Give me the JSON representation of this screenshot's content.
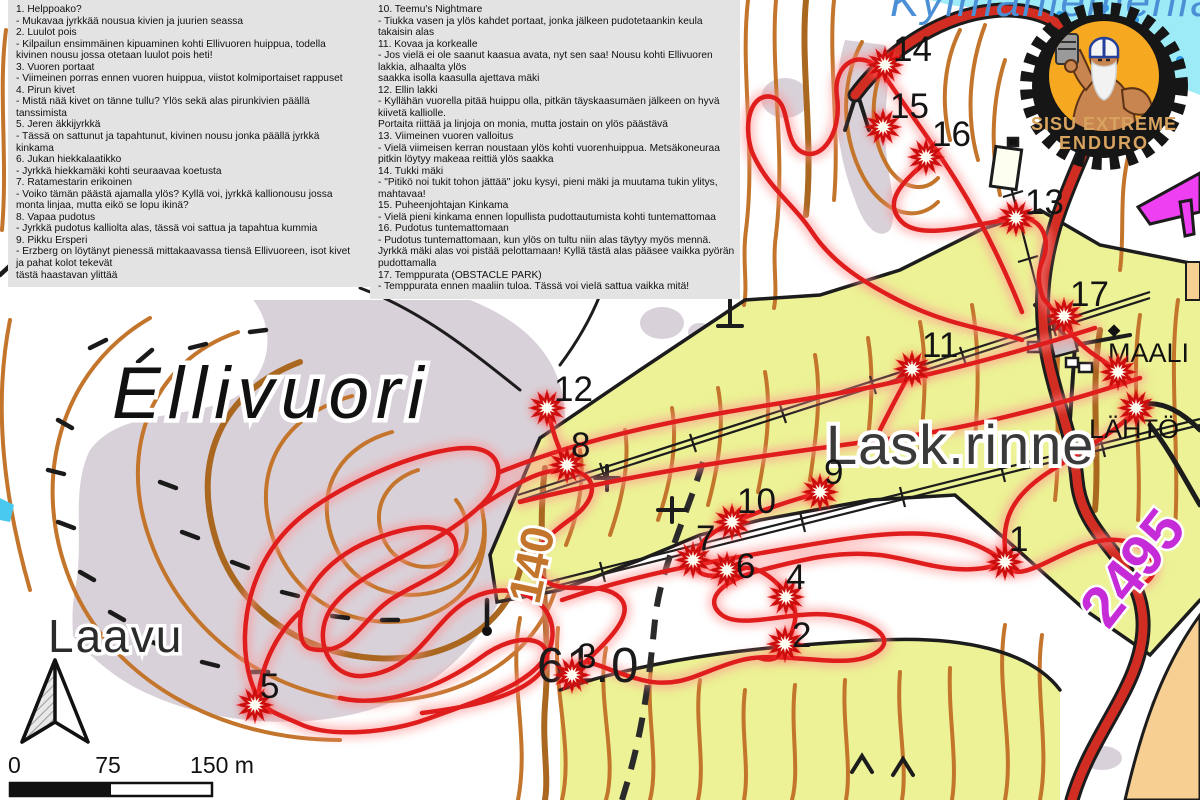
{
  "panels": {
    "left": {
      "lines": [
        "1. Helppoako?",
        "- Mukavaa jyrkkää nousua kivien ja juurien seassa",
        "2. Luulot pois",
        "- Kilpailun ensimmäinen kipuaminen kohti Ellivuoren huippua, todella",
        "kivinen nousu jossa otetaan luulot pois heti!",
        "3. Vuoren portaat",
        "- Viimeinen porras ennen vuoren huippua, viistot kolmiportaiset rappuset",
        "4. Pirun kivet",
        "- Mistä nää kivet on tänne tullu? Ylös sekä alas pirunkivien päällä",
        "tanssimista",
        "5. Jeren äkkijyrkkä",
        "- Tässä on sattunut ja tapahtunut, kivinen nousu jonka päällä jyrkkä",
        "kinkama",
        "6. Jukan hiekkalaatikko",
        "- Jyrkkä hiekkamäki kohti seuraavaa koetusta",
        "7. Ratamestarin erikoinen",
        "- Voiko tämän päästä ajamalla ylös? Kyllä voi, jyrkkä kallionousu jossa",
        "monta linjaa, mutta eikö se lopu ikinä?",
        "8. Vapaa pudotus",
        "- Jyrkkä pudotus kalliolta alas, tässä voi sattua ja tapahtua kummia",
        "9. Pikku Ersperi",
        "- Erzberg on löytänyt pienessä mittakaavassa tiensä Ellivuoreen, isot kivet",
        "ja pahat kolot tekevät",
        "tästä haastavan ylittää"
      ]
    },
    "right": {
      "lines": [
        "10. Teemu's Nightmare",
        "- Tiukka vasen ja ylös kahdet portaat, jonka jälkeen pudotetaankin keula",
        "takaisin alas",
        "11. Kovaa ja korkealle",
        "- Jos vielä ei ole saanut kaasua avata, nyt sen saa! Nousu kohti Ellivuoren",
        "lakkia, alhaalta ylös",
        "saakka isolla kaasulla ajettava mäki",
        "12. Ellin lakki",
        "- Kyllähän vuorella pitää huippu olla, pitkän täyskaasumäen jälkeen on hyvä",
        "kiivetä kalliolle.",
        "Portaita riittää ja linjoja on monia, mutta jostain on ylös päästävä",
        "13. Viimeinen vuoren valloitus",
        "- Vielä viimeisen kerran noustaan ylös kohti vuorenhuippua. Metsäkoneuraa",
        "pitkin löytyy makeaa reittiä ylös saakka",
        "14. Tukki mäki",
        "- \"Pitikö noi tukit tohon jättää\" joku kysyi, pieni mäki ja muutama tukin ylitys,",
        "mahtavaa!",
        "15. Puheenjohtajan Kinkama",
        "- Vielä pieni kinkama ennen lopullista pudottautumista kohti tuntemattomaa",
        "16. Pudotus tuntemattomaan",
        "- Pudotus tuntemattomaan, kun ylös on tultu niin alas täytyy myös mennä.",
        "Jyrkkä mäki alas voi pistää pelottamaan! Kyllä tästä alas pääsee vaikka pyörän",
        "pudottamalla",
        "17. Temppurata (OBSTACLE PARK)",
        "- Temppurata ennen maaliin tuloa. Tässä voi vielä sattua vaikka mitä!"
      ]
    }
  },
  "map": {
    "labels": {
      "hill": "Ellivuori",
      "shelter": "Laavu",
      "slope": "Lask.rinne",
      "finish": "MAALI",
      "start": "LÄHTÖ",
      "spot_height": "61.0",
      "contour_label": "140",
      "route_number": "2495",
      "lake": "Kylmäniemenlahti"
    },
    "checkpoints": [
      {
        "n": "1",
        "x": 1005,
        "y": 562,
        "lx": 1009,
        "ly": 551
      },
      {
        "n": "2",
        "x": 785,
        "y": 644,
        "lx": 792,
        "ly": 647
      },
      {
        "n": "3",
        "x": 572,
        "y": 675,
        "lx": 577,
        "ly": 668
      },
      {
        "n": "4",
        "x": 786,
        "y": 597,
        "lx": 786,
        "ly": 589
      },
      {
        "n": "5",
        "x": 255,
        "y": 705,
        "lx": 260,
        "ly": 698
      },
      {
        "n": "6",
        "x": 727,
        "y": 570,
        "lx": 736,
        "ly": 578
      },
      {
        "n": "7",
        "x": 693,
        "y": 560,
        "lx": 696,
        "ly": 550
      },
      {
        "n": "8",
        "x": 567,
        "y": 465,
        "lx": 571,
        "ly": 457
      },
      {
        "n": "9",
        "x": 820,
        "y": 492,
        "lx": 824,
        "ly": 484
      },
      {
        "n": "10",
        "x": 732,
        "y": 522,
        "lx": 737,
        "ly": 513
      },
      {
        "n": "11",
        "x": 912,
        "y": 369,
        "lx": 922,
        "ly": 357
      },
      {
        "n": "12",
        "x": 547,
        "y": 408,
        "lx": 554,
        "ly": 401
      },
      {
        "n": "13",
        "x": 1016,
        "y": 218,
        "lx": 1025,
        "ly": 214
      },
      {
        "n": "14",
        "x": 885,
        "y": 65,
        "lx": 893,
        "ly": 61
      },
      {
        "n": "15",
        "x": 883,
        "y": 127,
        "lx": 890,
        "ly": 118
      },
      {
        "n": "16",
        "x": 926,
        "y": 157,
        "lx": 932,
        "ly": 146
      },
      {
        "n": "17",
        "x": 1064,
        "y": 316,
        "lx": 1070,
        "ly": 306
      }
    ],
    "special_markers": [
      {
        "name": "finish-star-marker",
        "x": 1118,
        "y": 372
      },
      {
        "name": "start-star-marker",
        "x": 1136,
        "y": 408
      }
    ]
  },
  "logo": {
    "line1": "SISU EXTREME",
    "line2": "ENDURO"
  },
  "scalebar": {
    "zero": "0",
    "mid": "75",
    "end": "150 m"
  },
  "colors": {
    "track_red": "#e01d1d",
    "contour": "#c4752c",
    "slope_yellow": "#ecf295",
    "open_grey": "#d9d1d9",
    "lake_cyan": "#9debf7",
    "route_magenta": "#c62bd8",
    "road_red": "#d22d22",
    "private_tan": "#f8cf92",
    "logo_orange": "#f6a821",
    "logo_text": "#d8a35f"
  }
}
